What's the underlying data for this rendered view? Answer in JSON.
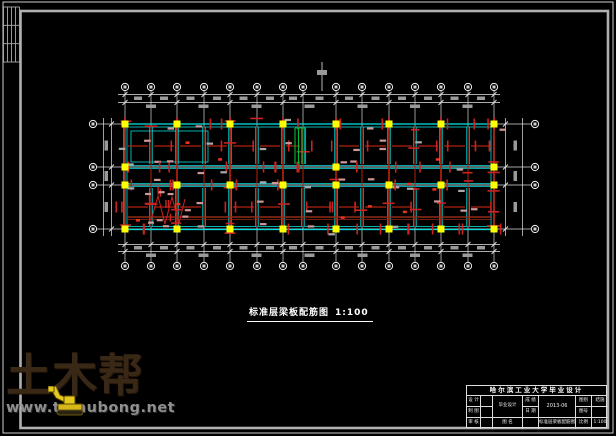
{
  "page": {
    "background": "#000000",
    "kind": "CAD structural drawing sheet"
  },
  "caption": {
    "title": "标准层梁板配筋图",
    "scale": "1:100"
  },
  "watermark": {
    "name": "土木帮",
    "url": "www.tumubong.net",
    "name_color": "#3a2817",
    "url_color": "#8f8f8f",
    "digger_color": "#e6c81e"
  },
  "title_block": {
    "header": "哈尔滨工业大学毕业设计",
    "roles": [
      "设 计",
      "制 图",
      "审 核"
    ],
    "project": "毕业设计",
    "name_label": "图 名",
    "grade_label": "成 绩",
    "date_label": "日 期",
    "date": "2013-06",
    "drawing_name": "标准层梁板配筋图",
    "sheet_type_label": "图别",
    "sheet_type": "结施",
    "sheet_no_label": "图号",
    "sheet_no": "",
    "scale_label": "比例",
    "scale": "1:100"
  },
  "frame": {
    "outer": {
      "x": 3,
      "y": 2,
      "w": 610,
      "h": 431,
      "color": "#cfcfcf"
    },
    "inner": {
      "x": 20.5,
      "y": 11,
      "w": 587.5,
      "h": 417,
      "color": "#b0b0b0"
    },
    "sign_table": {
      "x1": 3.5,
      "x2": 19.5,
      "y1": 7,
      "y2": 62,
      "cols": 4,
      "rows": 3,
      "color": "#aaaaaa"
    }
  },
  "plan": {
    "colors": {
      "grid": "#e6e6e6",
      "dim": "#9a9a9a",
      "bubble": "#f0f0f0",
      "column": "#ffff00",
      "wall": "#00dede",
      "beam": "#b22211",
      "beam_dark": "#8f2a18",
      "tick_pink": "#cc9898",
      "green": "#00bb33",
      "accent_red": "#ee3322"
    },
    "grid_xs": [
      125,
      151,
      177,
      204,
      230,
      257,
      283,
      303,
      336,
      362,
      389,
      415,
      441,
      468,
      494
    ],
    "main_xs": [
      125,
      177,
      230,
      283,
      336,
      389,
      441,
      494
    ],
    "grid_ys": [
      124,
      167,
      185,
      229
    ],
    "bubbles": {
      "top_y": 87,
      "bottom_y": 266,
      "left_x": 93,
      "right_x": 535,
      "r": 3.6
    },
    "building": {
      "x1": 124,
      "y1": 124,
      "x2": 494,
      "y2": 229
    },
    "corridor_ys": [
      167,
      185
    ],
    "dim": {
      "top_lines": [
        94.5,
        102.5
      ],
      "bottom_lines": [
        244.5,
        251.5
      ],
      "left_lines": [
        103.5,
        111.5
      ],
      "right_lines": [
        505.5,
        522.5
      ]
    },
    "beam_mid_ys": [
      146,
      207
    ],
    "long_beam_ys": [
      217,
      219.5
    ],
    "tick_rows": [
      124,
      146,
      167,
      185,
      207,
      229
    ],
    "columns": [
      [
        125,
        124
      ],
      [
        177,
        124
      ],
      [
        230,
        124
      ],
      [
        283,
        124
      ],
      [
        336,
        124
      ],
      [
        389,
        124
      ],
      [
        441,
        124
      ],
      [
        494,
        124
      ],
      [
        125,
        185
      ],
      [
        177,
        185
      ],
      [
        230,
        185
      ],
      [
        283,
        185
      ],
      [
        336,
        185
      ],
      [
        389,
        185
      ],
      [
        441,
        185
      ],
      [
        494,
        185
      ],
      [
        125,
        229
      ],
      [
        177,
        229
      ],
      [
        230,
        229
      ],
      [
        283,
        229
      ],
      [
        336,
        229
      ],
      [
        389,
        229
      ],
      [
        441,
        229
      ],
      [
        494,
        229
      ],
      [
        125,
        167
      ],
      [
        336,
        167
      ],
      [
        494,
        167
      ]
    ],
    "stair_green_xs": [
      295,
      298.5,
      302,
      305.5
    ],
    "stair_green_y": [
      128,
      164
    ],
    "stair_red_zigzag": [
      [
        150,
        224
      ],
      [
        158,
        196
      ],
      [
        165,
        224
      ],
      [
        172,
        197
      ],
      [
        179,
        223
      ],
      [
        185,
        199
      ]
    ],
    "left_room": {
      "x": 131,
      "y": 131,
      "w": 77,
      "h": 31
    },
    "section_mark": {
      "x": 322,
      "y1": 62,
      "y2": 91
    }
  }
}
